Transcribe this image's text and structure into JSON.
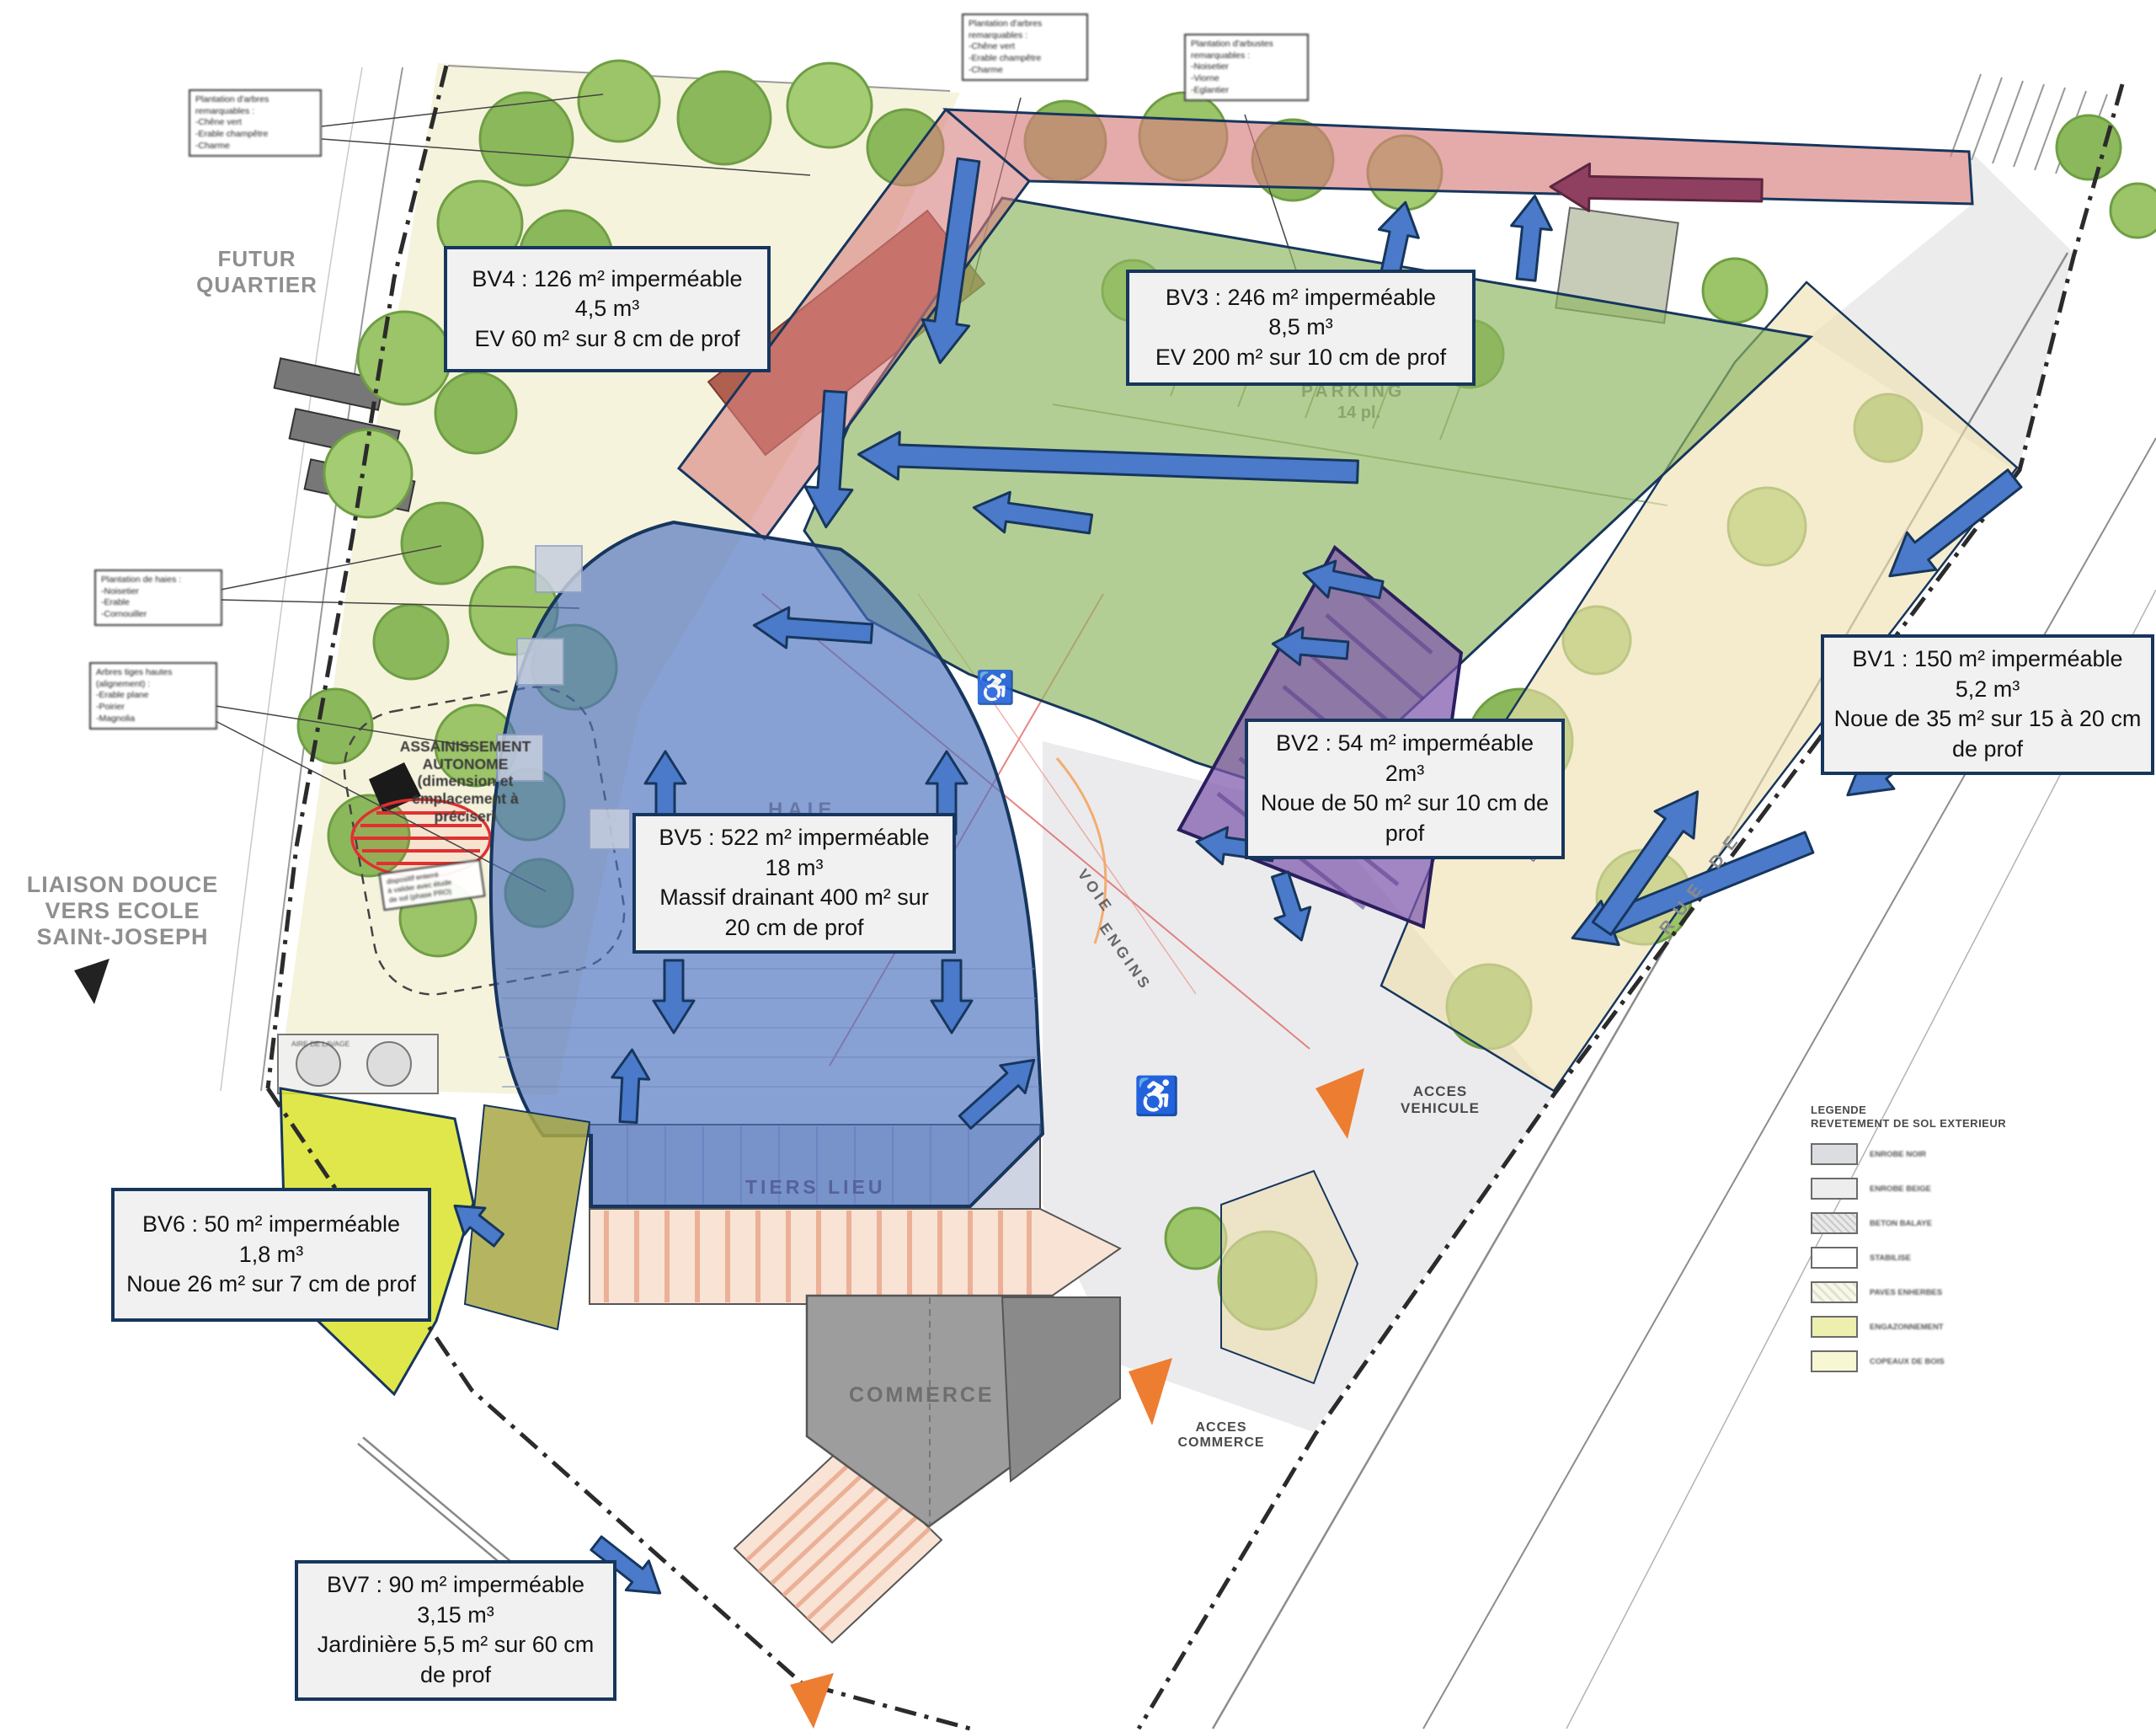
{
  "bv": {
    "bv1": {
      "lines": [
        "BV1 : 150 m² imperméable",
        "5,2 m³",
        "Noue de 35 m² sur 15 à 20 cm de prof"
      ]
    },
    "bv2": {
      "lines": [
        "BV2 : 54 m² imperméable",
        "2m³",
        "Noue de 50 m² sur 10 cm de prof"
      ]
    },
    "bv3": {
      "lines": [
        "BV3 : 246 m² imperméable",
        "8,5 m³",
        "EV 200 m² sur 10 cm de prof"
      ]
    },
    "bv4": {
      "lines": [
        "BV4 : 126 m² imperméable",
        "4,5 m³",
        "EV 60 m² sur 8 cm de prof"
      ]
    },
    "bv5": {
      "lines": [
        "BV5 : 522 m² imperméable",
        "18 m³",
        "Massif drainant 400 m² sur 20 cm de prof"
      ]
    },
    "bv6": {
      "lines": [
        "BV6 : 50 m² imperméable",
        "1,8 m³",
        "Noue 26 m² sur 7 cm de prof"
      ]
    },
    "bv7": {
      "lines": [
        "BV7 :  90 m² imperméable",
        "3,15 m³",
        "Jardinière 5,5 m² sur 60 cm de prof"
      ]
    }
  },
  "labels": {
    "futur_quartier": "FUTUR\nQUARTIER",
    "liaison_douce": "LIAISON DOUCE\nVERS ECOLE\nSAINt-JOSEPH",
    "assainissement": "ASSAINISSEMENT\nAUTONOME\n(dimension et\nemplacement à\npréciser)",
    "haie": "HAIE",
    "tiers_lieu": "TIERS LIEU",
    "commerce": "COMMERCE",
    "parking": "PARKING",
    "parking_places": "14 pl.",
    "acces_vehicule": "ACCES\nVEHICULE",
    "acces_commerce": "ACCES\nCOMMERCE",
    "voie": "VOIE",
    "engins": "ENGINS",
    "rue_de": "RUE  DE",
    "aire_lavage": "AIRE DE LAVAGE"
  },
  "callouts": {
    "arbres1": "Plantation d'arbres\nremarquables :\n-Chêne vert\n-Erable champêtre\n-Charme",
    "arbres2": "Plantation d'arbres\nremarquables :\n-Chêne vert\n-Erable champêtre\n-Charme",
    "arbustes": "Plantation d'arbustes\nremarquables :\n-Noisetier\n-Viorne\n-Eglantier",
    "haies": "Plantation de haies :\n-Noisetier\n-Erable\n-Cornouiller",
    "arbres_tige": "Arbres tiges hautes\n(alignement) :\n-Erable plane\n-Poirier\n-Magnolia",
    "assainissement_note": "dispositif enterré\nà valider avec étude\nde sol (phase PRO)"
  },
  "legend": {
    "title": "LEGENDE\nREVETEMENT DE SOL EXTERIEUR",
    "items": [
      {
        "label": "ENROBE NOIR"
      },
      {
        "label": "ENROBE BEIGE"
      },
      {
        "label": "BETON BALAYE"
      },
      {
        "label": "STABILISE"
      },
      {
        "label": "PAVES ENHERBES"
      },
      {
        "label": "ENGAZONNEMENT"
      },
      {
        "label": "COPEAUX DE BOIS"
      }
    ]
  },
  "icons": {
    "wheelchair": "♿"
  },
  "colors": {
    "box_border": "#17365d",
    "arrow_blue": "#4a7ac9",
    "arrow_maroon": "#8f4060",
    "zone_bv1_beige": "#efe0ae",
    "zone_bv2_purple": "#7e57ad",
    "zone_bv3_green": "#8fb763",
    "zone_bv4_red": "#d77f7f",
    "zone_bv5_blue": "#4a71bd",
    "zone_bv6_yellow": "#dbe32a",
    "acces_orange": "#ed7d31"
  }
}
